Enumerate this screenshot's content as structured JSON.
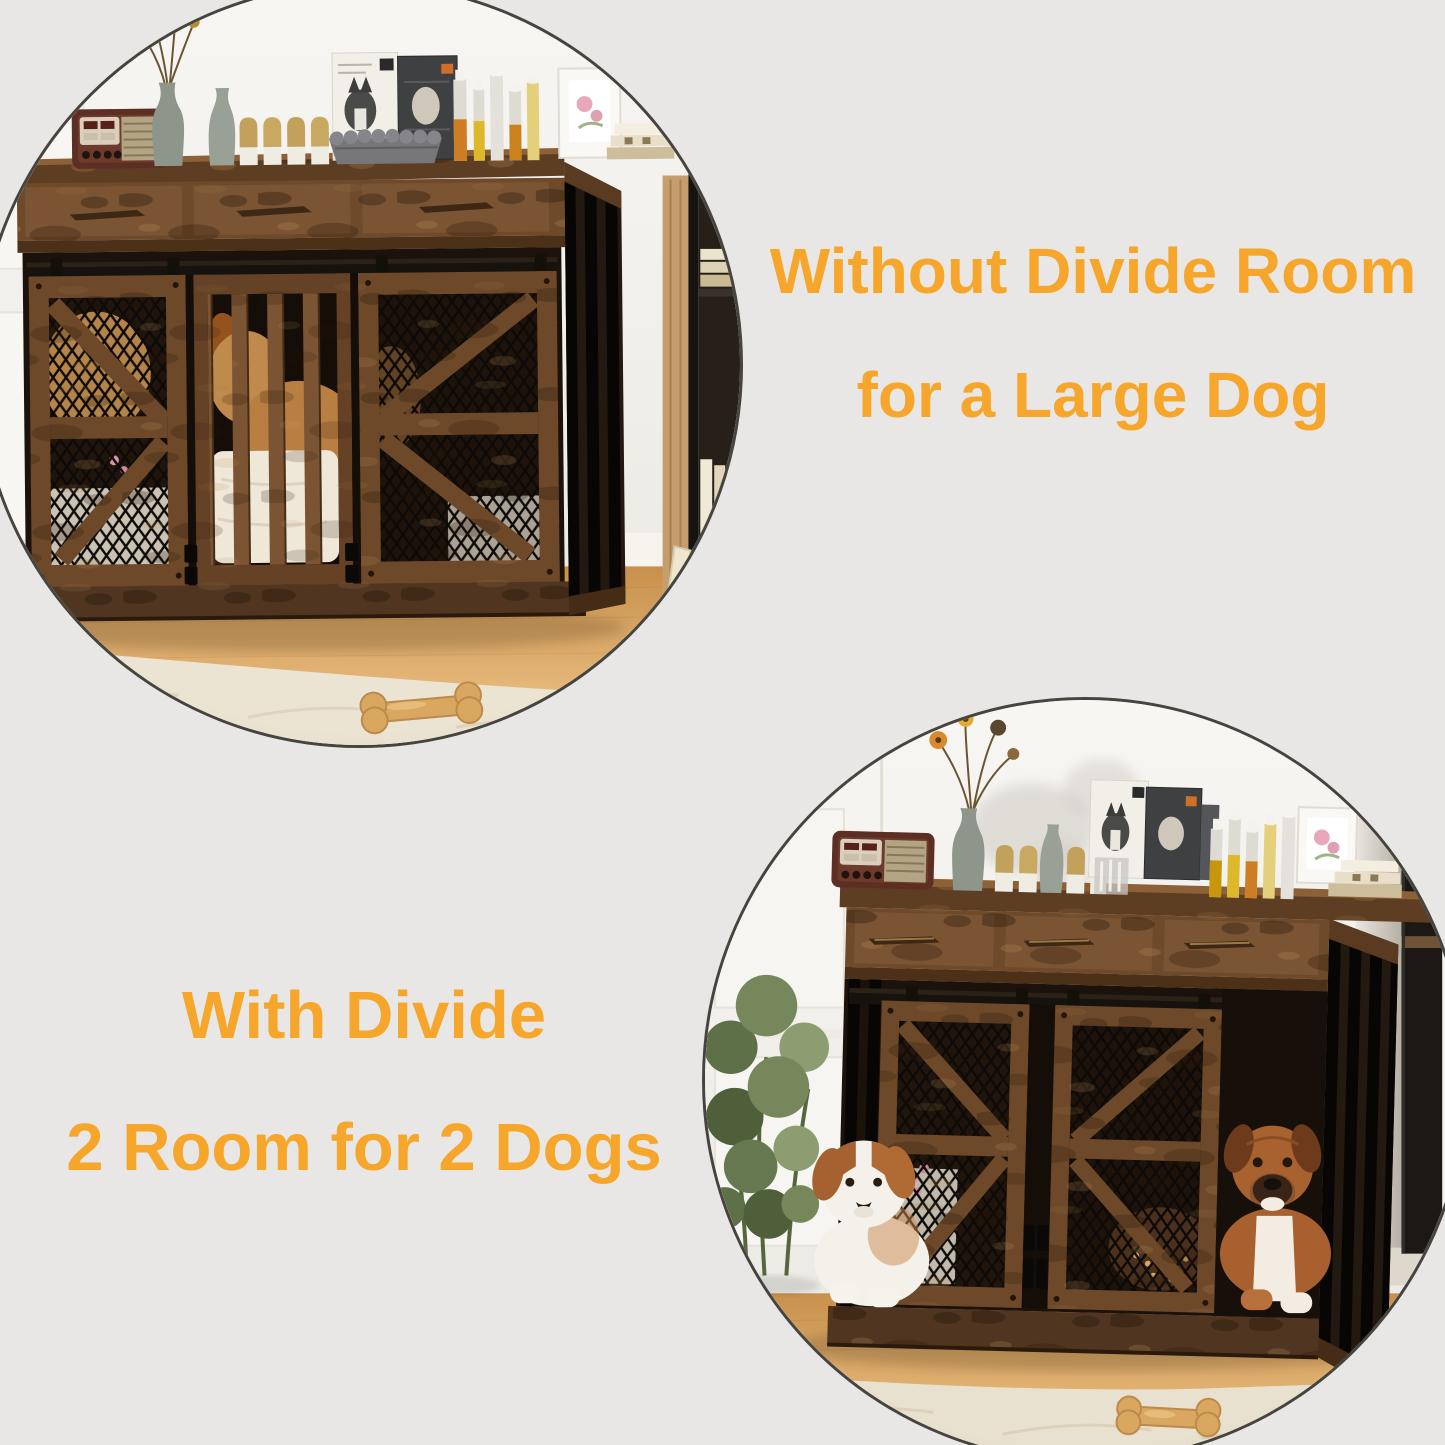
{
  "colors": {
    "accent": "#F5A62B",
    "canvas-bg": "#E8E7E5",
    "circle-border": "#45443F"
  },
  "captions": {
    "without_divider": {
      "line1": "Without Divide Room",
      "line2": "for a Large Dog"
    },
    "with_divider": {
      "line1": "With Divide",
      "line2": "2 Room for 2 Dogs"
    }
  },
  "scenes": {
    "without_divider": {
      "name": "dog-crate-single-room-photo",
      "items": [
        "vintage-radio",
        "flower-vase",
        "dried-flowers",
        "pet-lotion-bottles",
        "dog-food-boxes",
        "pet-bowl",
        "spray-tubes",
        "photo-frame",
        "books",
        "bookshelf",
        "dog-crate",
        "sliding-barn-doors",
        "golden-retriever",
        "dog-bed-cushion",
        "wood-floor",
        "area-rug",
        "dog-bone",
        "yellow-ball"
      ]
    },
    "with_divider": {
      "name": "dog-crate-two-room-photo",
      "items": [
        "vintage-radio",
        "flower-vase",
        "dried-flowers",
        "pet-lotion-bottles",
        "dog-food-boxes",
        "spray-tubes",
        "photo-frame",
        "books",
        "potted-plant",
        "dog-crate-with-divider",
        "sliding-barn-doors",
        "white-brown-dog",
        "boxer-dog",
        "dog-bone",
        "wood-floor",
        "area-rug",
        "side-shelf"
      ]
    }
  }
}
